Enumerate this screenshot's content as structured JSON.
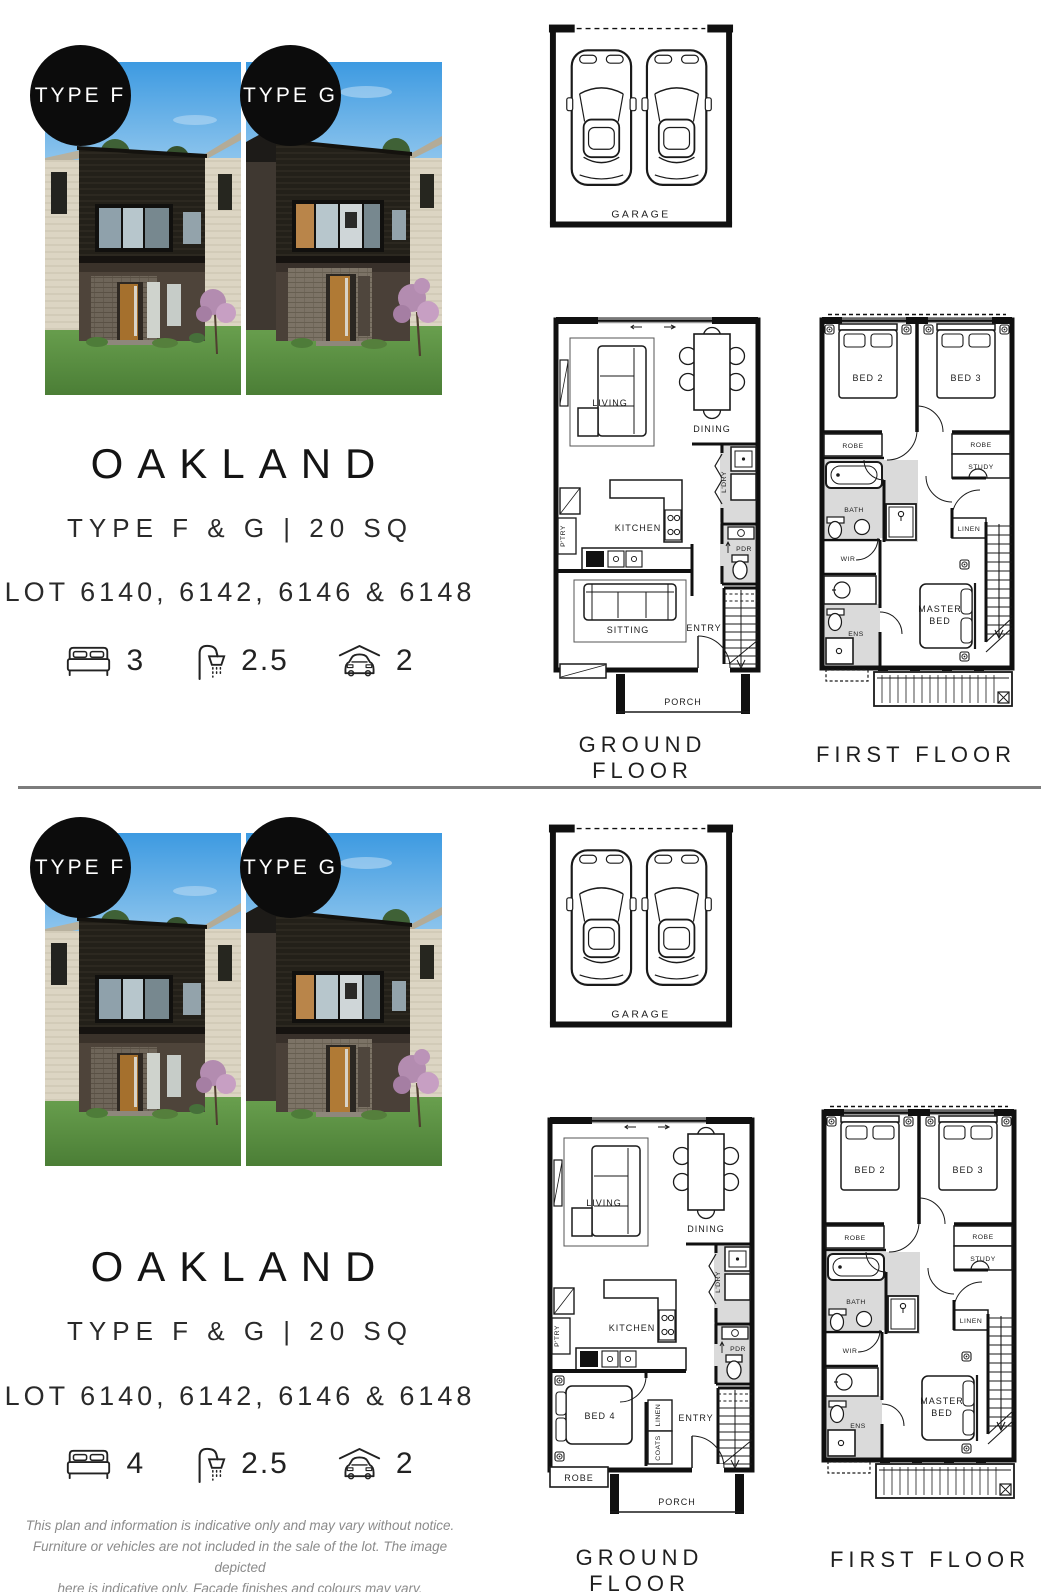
{
  "sections": [
    {
      "badge_left": "TYPE F",
      "badge_right": "TYPE G",
      "title": "OAKLAND",
      "subtitle": "TYPE F & G | 20 SQ",
      "lots": "LOT 6140, 6142, 6146 & 6148",
      "stats": {
        "beds": "3",
        "baths": "2.5",
        "cars": "2"
      },
      "ground_floor_label": "GROUND FLOOR",
      "first_floor_label": "FIRST FLOOR"
    },
    {
      "badge_left": "TYPE F",
      "badge_right": "TYPE G",
      "title": "OAKLAND",
      "subtitle": "TYPE F & G | 20 SQ",
      "lots": "LOT 6140, 6142, 6146 & 6148",
      "stats": {
        "beds": "4",
        "baths": "2.5",
        "cars": "2"
      },
      "ground_floor_label": "GROUND FLOOR",
      "first_floor_label": "FIRST FLOOR"
    }
  ],
  "plans": {
    "garage": {
      "label": "GARAGE"
    },
    "ground_a": {
      "living": "LIVING",
      "dining": "DINING",
      "laundry": "L'DRY",
      "pantry": "P'TRY",
      "kitchen": "KITCHEN",
      "powder": "PDR",
      "sitting": "SITTING",
      "entry": "ENTRY",
      "porch": "PORCH"
    },
    "ground_b": {
      "living": "LIVING",
      "dining": "DINING",
      "laundry": "L'DRY",
      "pantry": "P'TRY",
      "kitchen": "KITCHEN",
      "powder": "PDR",
      "bed4": "BED 4",
      "linen": "LINEN",
      "coats": "COATS",
      "robe": "ROBE",
      "entry": "ENTRY",
      "porch": "PORCH"
    },
    "first": {
      "bed2": "BED 2",
      "bed3": "BED 3",
      "robe_left": "ROBE",
      "robe_right": "ROBE",
      "study": "STUDY",
      "bath": "BATH",
      "wir": "WIR",
      "ens": "ENS",
      "linen": "LINEN",
      "master1": "MASTER",
      "master2": "BED"
    }
  },
  "footer": {
    "line1": "This plan and information is indicative only and may vary without notice.",
    "line2": "Furniture or vehicles are not included in the sale of the lot. The image depicted",
    "line3": "here is indicative only. Facade finishes and colours may vary."
  }
}
